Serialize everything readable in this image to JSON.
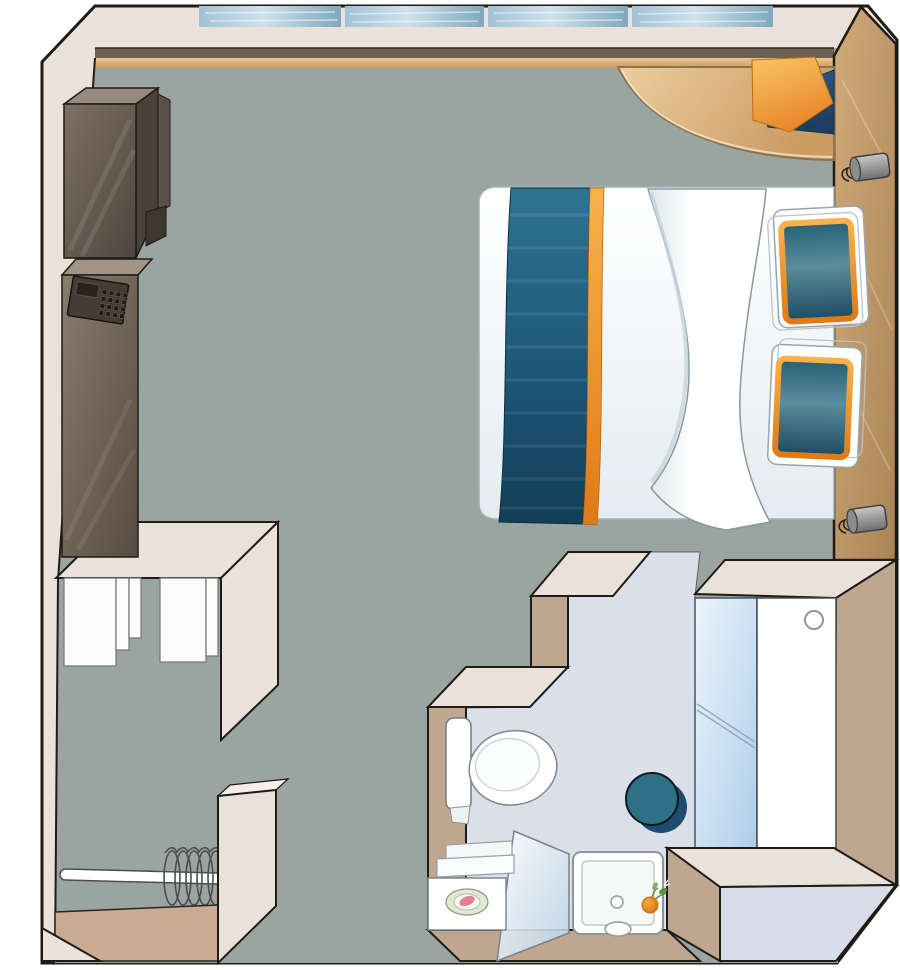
{
  "meta": {
    "title": "Cabin floor plan",
    "type": "top-down floor plan diagram",
    "rooms": [
      "main cabin",
      "bathroom",
      "entry with open closet"
    ]
  },
  "inventory": {
    "cabin": [
      "panoramic-window",
      "window-ledge",
      "corner-desk",
      "desk-cloths",
      "double-bed",
      "bed-runner",
      "pillows",
      "headboard-wall",
      "reading-lamps",
      "tv-cabinet",
      "safe-unit",
      "closet-shelves",
      "clothes-rail-with-hangers"
    ],
    "bathroom": [
      "toilet",
      "stool",
      "shower-tray",
      "shower-glass-door",
      "vanity-counter",
      "soap-dish",
      "mirror",
      "bathroom-door",
      "plant"
    ]
  },
  "palette": {
    "outline": "#1f1b16",
    "wallFace": "#eae2d9",
    "wallFaceLight": "#f4efe8",
    "wallSide": "#bfa68f",
    "floorGray": "#9aa4a0",
    "bathFloor": "#d9e0ea",
    "entranceFloor": "#d6dde8",
    "entryTan": "#c9aa93",
    "windowLight": "#cfe0ea",
    "windowMid": "#9fc2d4",
    "windowDark": "#7fa8bd",
    "ledgeBrown": "#6d5f52",
    "ledgeTanL": "#ecc78f",
    "ledgeTanD": "#c89a5e",
    "woodWallL": "#d2ab7a",
    "woodWallD": "#aa8357",
    "deskL": "#eccda0",
    "deskD": "#cb9c63",
    "cabinetTop": "#958a7d",
    "cabinetSide": "#4a423a",
    "cabinetSliver": "#5c5148",
    "cabinetFrontL": "#7d7165",
    "cabinetFrontD": "#4f453d",
    "bracket": "#3e3730",
    "safeTop": "#a29484",
    "safeFrontL": "#8a7c6d",
    "safeFrontD": "#574c41",
    "keypad": "#453c33",
    "keypadScreen": "#29231c",
    "keypadBtn": "#1f1a15",
    "linen": "#fdfdfd",
    "duvetTop": "#ffffff",
    "duvetEdge": "#e4ecef",
    "runnerL": "#2f7392",
    "runnerM": "#1e5a7c",
    "runnerD": "#123d55",
    "trimL": "#f8b24c",
    "trimD": "#e07a16",
    "pillowTop": "#266074",
    "pillowL": "#5b8d9c",
    "pillowD": "#1d4a60",
    "blanketL": "#ffffff",
    "blanketSh": "#dde7ea",
    "clothOL": "#f9c566",
    "clothOD": "#e8872a",
    "clothNL": "#33618c",
    "clothND": "#1d3e5e",
    "lampL": "#c6c6c6",
    "lampD": "#6f6f6f",
    "stoolTeal": "#2e7187",
    "stoolShadow": "#1d4c6e",
    "mirrorL": "#ecf5fc",
    "mirrorD": "#aecde9",
    "doorWhite": "#ffffff",
    "glassL": "rgba(255,255,255,0.92)",
    "glassD": "rgba(186,210,230,0.85)",
    "toiletWhite": "#ffffff",
    "trayWhite": "#ffffff",
    "soapPink": "#e2809a",
    "dishGreen": "#e0e9d1",
    "plantGreen": "#5f9140",
    "bloomL": "#f6a93c",
    "bloomD": "#d96f12"
  }
}
